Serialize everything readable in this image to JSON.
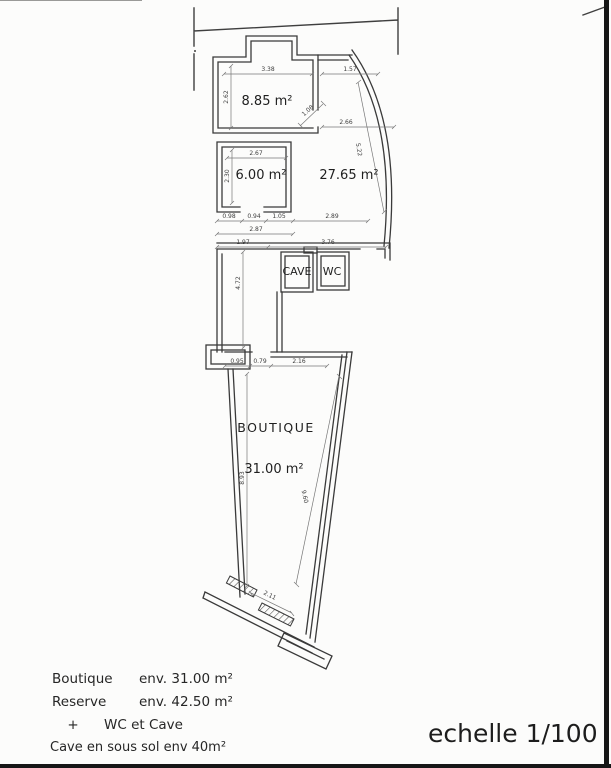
{
  "plan": {
    "room_labels": {
      "reserve_room1": "8.85 m²",
      "reserve_room2": "6.00 m²",
      "reserve_room3": "27.65 m²",
      "cave": "CAVE",
      "wc": "WC",
      "boutique_name": "BOUTIQUE",
      "boutique_area": "31.00 m²"
    },
    "dimensions": {
      "room1_width": "3.38",
      "top_right_width": "1.57",
      "room1_height": "2.62",
      "diagonal": "1.08",
      "mid_width": "2.66",
      "right_wall": "5.22",
      "room2_width": "2.67",
      "room2_height": "2.30",
      "chain_row1": [
        "0.98",
        "0.94",
        "1.05",
        "2.89"
      ],
      "chain_row2": "2.87",
      "chain_row3": [
        "1.97",
        "3.76"
      ],
      "corridor": "4.72",
      "boutique_chain": [
        "0.95",
        "0.79",
        "2.16"
      ],
      "boutique_left": "8.93",
      "boutique_right": "9.60",
      "entry": "2.11"
    }
  },
  "legend": {
    "rows": [
      {
        "label": "Boutique",
        "value": "env. 31.00 m²"
      },
      {
        "label": "Reserve",
        "value": "env. 42.50 m²"
      }
    ],
    "plus": "+",
    "wc_cave": "WC et Cave",
    "cave_note": "Cave en sous sol env 40m²"
  },
  "scale": {
    "label": "echelle 1/100"
  },
  "colors": {
    "wall": "#3a3a3a",
    "dim": "#787878",
    "paper": "#fcfcfb",
    "scan_border": "#161616"
  }
}
